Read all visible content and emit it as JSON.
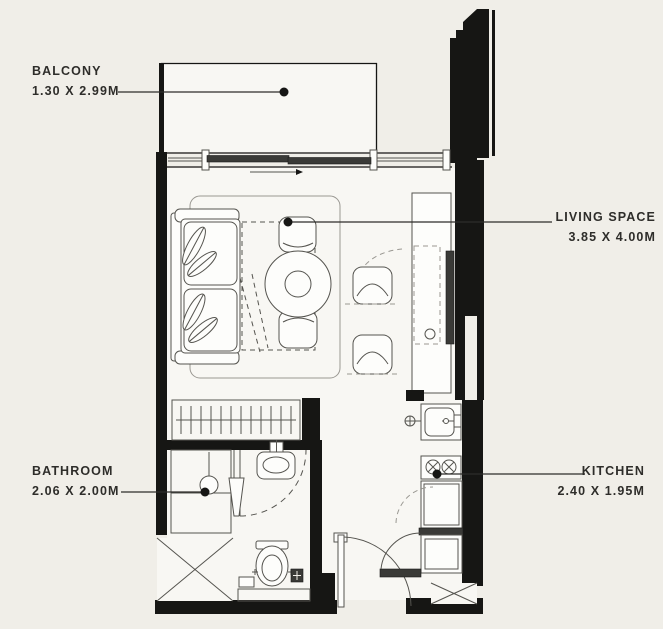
{
  "plan_type": "studio-apartment-floor-plan",
  "colors": {
    "background": "#f0eee8",
    "floor": "#f8f7f3",
    "wall": "#161614",
    "line": "#55544f",
    "soft": "#9a9892",
    "text": "#2e2d2a",
    "panel": "#3a3a37"
  },
  "rooms": {
    "balcony": {
      "name": "BALCONY",
      "dimensions": "1.30 X 2.99M"
    },
    "living": {
      "name": "LIVING SPACE",
      "dimensions": "3.85 X 4.00M"
    },
    "bathroom": {
      "name": "BATHROOM",
      "dimensions": "2.06 X 2.00M"
    },
    "kitchen": {
      "name": "KITCHEN",
      "dimensions": "2.40 X 1.95M"
    }
  },
  "fixtures": [
    "sofa",
    "area-rug",
    "round-dining-table",
    "dining-chair-top",
    "dining-chair-bottom",
    "lounge-chair-upper",
    "lounge-chair-lower",
    "tv",
    "console-counter",
    "sliding-balcony-door",
    "wardrobe-hanging-rail",
    "shower",
    "shower-head",
    "bathroom-door",
    "washbasin",
    "toilet",
    "floor-drain",
    "kitchen-sink",
    "gas-hob",
    "fridge",
    "washing-machine",
    "entry-door",
    "entry-door-panel",
    "service-shaft-left",
    "service-shaft-kitchen"
  ]
}
